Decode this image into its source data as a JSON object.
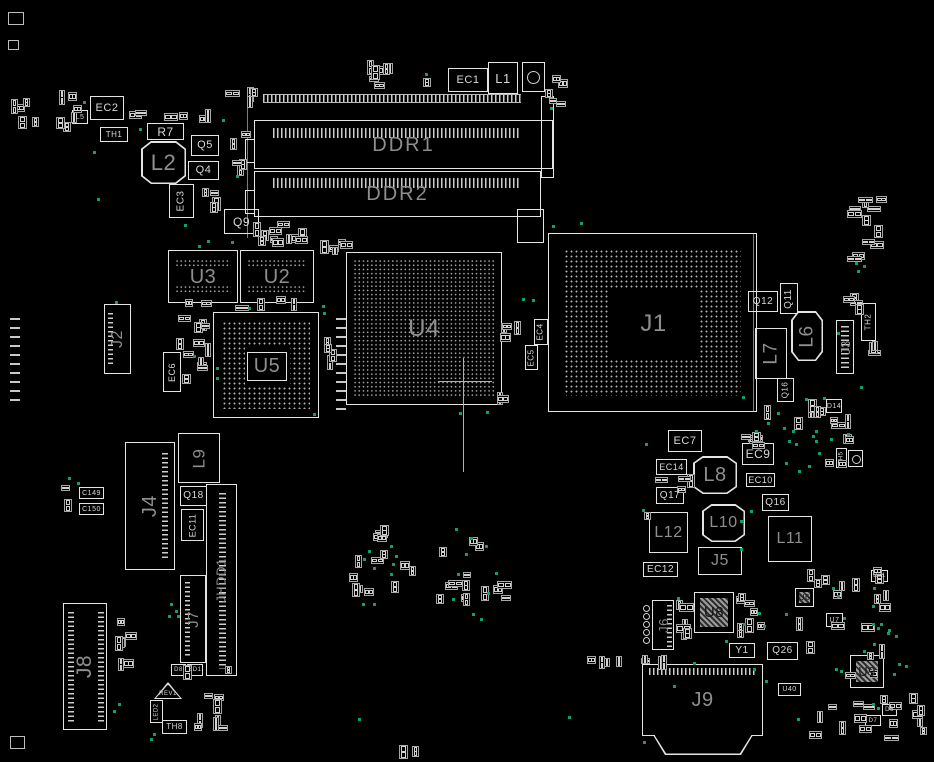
{
  "colors": {
    "background": "#000000",
    "outline": "#e4e4e4",
    "trace": "#7d7d7d",
    "label_bright": "#d8d8d8",
    "label_dim": "#8e8e8e",
    "label_dark": "#161616",
    "test_point": "#0aa076",
    "crosshair": "#e09aa2",
    "pad": "#d2d2d2",
    "small_part": "#a6a6a6"
  },
  "crosshair": {
    "x": 463,
    "y": 381,
    "v_from": 358,
    "v_to": 472,
    "h_from": 438,
    "h_to": 492
  },
  "lines": [
    [
      247,
      100,
      138
    ],
    [
      753,
      233,
      179
    ]
  ],
  "marks": [
    [
      8,
      12,
      16,
      13
    ],
    [
      8,
      40,
      11,
      10
    ],
    [
      10,
      736,
      15,
      13
    ]
  ],
  "padcols": [
    [
      10,
      318,
      10,
      88
    ],
    [
      336,
      318,
      10,
      96
    ]
  ],
  "dimm": {
    "strip_top": [
      263,
      94,
      258,
      9
    ],
    "slot1": {
      "box": [
        254,
        120,
        299,
        49
      ],
      "strip": [
        272,
        127,
        248,
        10
      ],
      "label": "DDR1"
    },
    "slot2": {
      "box": [
        254,
        171,
        287,
        46
      ],
      "strip": [
        272,
        177,
        248,
        10
      ],
      "label": "DDR2"
    },
    "right_bar": [
      541,
      96,
      13,
      82
    ],
    "notch": [
      517,
      209,
      27,
      34
    ],
    "ears": [
      [
        245,
        139,
        10,
        24
      ],
      [
        245,
        190,
        10,
        24
      ]
    ]
  },
  "components": [
    {
      "label": "EC1",
      "x": 448,
      "y": 68,
      "w": 40,
      "h": 24,
      "fs": 11
    },
    {
      "label": "L1",
      "x": 488,
      "y": 62,
      "w": 30,
      "h": 32,
      "fs": 13
    },
    {
      "label": "",
      "x": 522,
      "y": 62,
      "w": 23,
      "h": 30,
      "t": "circ"
    },
    {
      "label": "EC2",
      "x": 90,
      "y": 96,
      "w": 34,
      "h": 24,
      "fs": 11
    },
    {
      "label": "L5",
      "x": 72,
      "y": 110,
      "w": 16,
      "h": 14,
      "fs": 7
    },
    {
      "label": "TH1",
      "x": 100,
      "y": 127,
      "w": 28,
      "h": 15,
      "fs": 8
    },
    {
      "label": "R7",
      "x": 147,
      "y": 123,
      "w": 37,
      "h": 17,
      "fs": 12
    },
    {
      "label": "L2",
      "x": 141,
      "y": 141,
      "w": 45,
      "h": 43,
      "fs": 22,
      "t": "octo",
      "c": "dim"
    },
    {
      "label": "Q5",
      "x": 191,
      "y": 135,
      "w": 28,
      "h": 21,
      "fs": 11
    },
    {
      "label": "Q4",
      "x": 188,
      "y": 161,
      "w": 31,
      "h": 19,
      "fs": 11
    },
    {
      "label": "EC3",
      "x": 169,
      "y": 184,
      "w": 25,
      "h": 34,
      "fs": 10,
      "rot": 1
    },
    {
      "label": "Q9",
      "x": 224,
      "y": 209,
      "w": 35,
      "h": 25,
      "fs": 12
    },
    {
      "label": "U3",
      "x": 168,
      "y": 250,
      "w": 70,
      "h": 53,
      "fs": 20,
      "t": "band",
      "c": "dim"
    },
    {
      "label": "U2",
      "x": 240,
      "y": 250,
      "w": 74,
      "h": 53,
      "fs": 20,
      "t": "band",
      "c": "dim"
    },
    {
      "label": "J2",
      "x": 104,
      "y": 304,
      "w": 27,
      "h": 70,
      "fs": 16,
      "rot": 1,
      "t": "conn",
      "c": "dim",
      "strips": [
        [
          3,
          8,
          5,
          52
        ]
      ]
    },
    {
      "label": "U5",
      "x": 213,
      "y": 312,
      "w": 106,
      "h": 106,
      "fs": 20,
      "t": "bgacenter",
      "c": "dim",
      "inset": 8,
      "cbox": 1
    },
    {
      "label": "EC6",
      "x": 163,
      "y": 352,
      "w": 18,
      "h": 40,
      "fs": 9,
      "rot": 1
    },
    {
      "label": "U4",
      "x": 346,
      "y": 252,
      "w": 156,
      "h": 153,
      "fs": 24,
      "t": "bgagrid",
      "c": "dim"
    },
    {
      "label": "EC4",
      "x": 534,
      "y": 319,
      "w": 14,
      "h": 26,
      "fs": 8,
      "rot": 1
    },
    {
      "label": "EC5",
      "x": 525,
      "y": 345,
      "w": 13,
      "h": 25,
      "fs": 8,
      "rot": 1
    },
    {
      "label": "J1",
      "x": 548,
      "y": 233,
      "w": 209,
      "h": 179,
      "fs": 24,
      "t": "bgacenter",
      "c": "dim",
      "inset": 15
    },
    {
      "label": "Q12",
      "x": 748,
      "y": 291,
      "w": 30,
      "h": 21,
      "fs": 10
    },
    {
      "label": "Q11",
      "x": 780,
      "y": 283,
      "w": 18,
      "h": 31,
      "fs": 10,
      "rot": 1
    },
    {
      "label": "L7",
      "x": 755,
      "y": 328,
      "w": 32,
      "h": 51,
      "fs": 19,
      "rot": 1,
      "c": "dim"
    },
    {
      "label": "L6",
      "x": 791,
      "y": 311,
      "w": 32,
      "h": 50,
      "fs": 19,
      "rot": 1,
      "t": "octo",
      "c": "dim"
    },
    {
      "label": "J3",
      "x": 836,
      "y": 320,
      "w": 18,
      "h": 54,
      "fs": 13,
      "rot": 1,
      "t": "conn",
      "c": "dim",
      "strips": [
        [
          4,
          5,
          8,
          44
        ]
      ]
    },
    {
      "label": "Q16",
      "x": 777,
      "y": 378,
      "w": 17,
      "h": 24,
      "fs": 8,
      "rot": 1
    },
    {
      "label": "TH2",
      "x": 861,
      "y": 303,
      "w": 15,
      "h": 38,
      "fs": 8,
      "rot": 1
    },
    {
      "label": "D14",
      "x": 826,
      "y": 399,
      "w": 16,
      "h": 14,
      "fs": 7
    },
    {
      "label": "TH5",
      "x": 836,
      "y": 448,
      "w": 11,
      "h": 20,
      "fs": 6,
      "rot": 1
    },
    {
      "label": "",
      "x": 848,
      "y": 450,
      "w": 15,
      "h": 17,
      "t": "circ"
    },
    {
      "label": "EC7",
      "x": 668,
      "y": 430,
      "w": 34,
      "h": 22,
      "fs": 11
    },
    {
      "label": "EC14",
      "x": 656,
      "y": 459,
      "w": 31,
      "h": 16,
      "fs": 9
    },
    {
      "label": "EC9",
      "x": 742,
      "y": 443,
      "w": 32,
      "h": 22,
      "fs": 12
    },
    {
      "label": "L8",
      "x": 693,
      "y": 456,
      "w": 44,
      "h": 38,
      "fs": 20,
      "t": "octo",
      "c": "dim"
    },
    {
      "label": "EC10",
      "x": 746,
      "y": 473,
      "w": 29,
      "h": 14,
      "fs": 9
    },
    {
      "label": "Q17",
      "x": 656,
      "y": 487,
      "w": 28,
      "h": 17,
      "fs": 10
    },
    {
      "label": "Q16",
      "x": 762,
      "y": 494,
      "w": 27,
      "h": 17,
      "fs": 10
    },
    {
      "label": "L12",
      "x": 649,
      "y": 512,
      "w": 39,
      "h": 41,
      "fs": 16,
      "c": "dim"
    },
    {
      "label": "L10",
      "x": 702,
      "y": 504,
      "w": 43,
      "h": 38,
      "fs": 16,
      "t": "octo",
      "c": "dim"
    },
    {
      "label": "L11",
      "x": 768,
      "y": 516,
      "w": 44,
      "h": 46,
      "fs": 16,
      "c": "dim"
    },
    {
      "label": "J5",
      "x": 698,
      "y": 547,
      "w": 44,
      "h": 28,
      "fs": 16,
      "c": "dim"
    },
    {
      "label": "EC12",
      "x": 643,
      "y": 562,
      "w": 35,
      "h": 15,
      "fs": 10
    },
    {
      "label": "C149",
      "x": 79,
      "y": 487,
      "w": 25,
      "h": 12,
      "fs": 7
    },
    {
      "label": "C150",
      "x": 79,
      "y": 503,
      "w": 25,
      "h": 12,
      "fs": 7
    },
    {
      "label": "J4",
      "x": 125,
      "y": 442,
      "w": 50,
      "h": 128,
      "fs": 20,
      "rot": 1,
      "t": "conn",
      "c": "dim",
      "strips": [
        [
          36,
          10,
          6,
          108
        ]
      ]
    },
    {
      "label": "L9",
      "x": 178,
      "y": 433,
      "w": 42,
      "h": 50,
      "fs": 17,
      "rot": 1,
      "c": "dim"
    },
    {
      "label": "Q18",
      "x": 180,
      "y": 486,
      "w": 27,
      "h": 20,
      "fs": 10
    },
    {
      "label": "EC11",
      "x": 181,
      "y": 509,
      "w": 23,
      "h": 32,
      "fs": 9,
      "rot": 1
    },
    {
      "label": "JHDD1",
      "x": 206,
      "y": 484,
      "w": 31,
      "h": 192,
      "fs": 13,
      "rot": 1,
      "t": "conn",
      "c": "dim",
      "strips": [
        [
          12,
          8,
          7,
          176
        ]
      ]
    },
    {
      "label": "J7",
      "x": 180,
      "y": 575,
      "w": 26,
      "h": 88,
      "fs": 15,
      "rot": 1,
      "t": "conn",
      "c": "dim",
      "strips": [
        [
          4,
          6,
          5,
          76
        ]
      ]
    },
    {
      "label": "J8",
      "x": 63,
      "y": 603,
      "w": 44,
      "h": 127,
      "fs": 21,
      "rot": 1,
      "t": "conn",
      "c": "dim",
      "strips": [
        [
          4,
          8,
          6,
          110
        ],
        [
          34,
          8,
          6,
          110
        ]
      ]
    },
    {
      "label": "D8",
      "x": 171,
      "y": 664,
      "w": 15,
      "h": 12,
      "fs": 6
    },
    {
      "label": "ZD1",
      "x": 187,
      "y": 664,
      "w": 16,
      "h": 12,
      "fs": 6
    },
    {
      "label": "REV1",
      "x": 154,
      "y": 682,
      "w": 28,
      "h": 17,
      "fs": 6,
      "t": "tri"
    },
    {
      "label": "LED2",
      "x": 150,
      "y": 700,
      "w": 13,
      "h": 23,
      "fs": 6,
      "rot": 1
    },
    {
      "label": "TH8",
      "x": 162,
      "y": 720,
      "w": 25,
      "h": 14,
      "fs": 8
    },
    {
      "label": "J6",
      "x": 652,
      "y": 600,
      "w": 22,
      "h": 50,
      "fs": 13,
      "rot": 1,
      "t": "conn",
      "c": "dim",
      "strips": [
        [
          14,
          4,
          5,
          42
        ]
      ],
      "circles": {
        "x": 643,
        "y": 605,
        "n": 5,
        "d": 7,
        "step": 8
      }
    },
    {
      "label": "U8",
      "x": 694,
      "y": 592,
      "w": 40,
      "h": 41,
      "fs": 15,
      "t": "qfn"
    },
    {
      "label": "Y1",
      "x": 729,
      "y": 643,
      "w": 26,
      "h": 15,
      "fs": 10
    },
    {
      "label": "Q26",
      "x": 767,
      "y": 642,
      "w": 31,
      "h": 18,
      "fs": 10
    },
    {
      "label": "U40",
      "x": 778,
      "y": 683,
      "w": 23,
      "h": 13,
      "fs": 7
    },
    {
      "label": "J9",
      "x": 642,
      "y": 664,
      "w": 121,
      "h": 72,
      "fs": 20,
      "t": "j9",
      "c": "dim"
    },
    {
      "label": "U6",
      "x": 795,
      "y": 588,
      "w": 19,
      "h": 19,
      "fs": 8,
      "t": "qfn"
    },
    {
      "label": "U7",
      "x": 826,
      "y": 613,
      "w": 17,
      "h": 14,
      "fs": 7
    },
    {
      "label": "D21",
      "x": 871,
      "y": 570,
      "w": 17,
      "h": 12,
      "fs": 6
    },
    {
      "label": "U9",
      "x": 850,
      "y": 655,
      "w": 34,
      "h": 33,
      "fs": 13,
      "t": "qfn"
    },
    {
      "label": "D6",
      "x": 882,
      "y": 704,
      "w": 15,
      "h": 12,
      "fs": 6
    },
    {
      "label": "D7",
      "x": 865,
      "y": 715,
      "w": 16,
      "h": 11,
      "fs": 6
    }
  ],
  "clusters": [
    [
      55,
      85,
      35,
      48,
      6
    ],
    [
      8,
      92,
      34,
      38,
      5
    ],
    [
      128,
      108,
      100,
      16,
      6
    ],
    [
      225,
      85,
      35,
      28,
      4
    ],
    [
      228,
      130,
      24,
      78,
      5
    ],
    [
      200,
      185,
      24,
      52,
      4
    ],
    [
      250,
      218,
      64,
      30,
      7
    ],
    [
      255,
      236,
      110,
      14,
      6
    ],
    [
      180,
      296,
      130,
      16,
      6
    ],
    [
      318,
      238,
      28,
      22,
      3
    ],
    [
      360,
      60,
      72,
      34,
      8
    ],
    [
      543,
      68,
      30,
      46,
      5
    ],
    [
      496,
      320,
      36,
      24,
      4
    ],
    [
      497,
      392,
      20,
      13,
      2
    ],
    [
      175,
      315,
      37,
      72,
      12
    ],
    [
      320,
      330,
      22,
      84,
      4
    ],
    [
      640,
      470,
      58,
      54,
      5
    ],
    [
      738,
      420,
      26,
      25,
      3
    ],
    [
      748,
      398,
      110,
      72,
      15
    ],
    [
      845,
      195,
      45,
      68,
      12
    ],
    [
      840,
      293,
      26,
      24,
      4
    ],
    [
      795,
      565,
      105,
      68,
      14
    ],
    [
      730,
      585,
      38,
      54,
      8
    ],
    [
      635,
      655,
      45,
      16,
      4
    ],
    [
      676,
      600,
      20,
      52,
      6
    ],
    [
      800,
      640,
      130,
      116,
      18
    ],
    [
      345,
      525,
      75,
      84,
      14
    ],
    [
      425,
      530,
      90,
      84,
      14
    ],
    [
      108,
      618,
      30,
      58,
      8
    ],
    [
      182,
      652,
      58,
      90,
      10
    ],
    [
      398,
      745,
      28,
      13,
      3
    ],
    [
      60,
      484,
      14,
      32,
      2
    ],
    [
      868,
      338,
      12,
      22,
      3
    ],
    [
      905,
      698,
      25,
      42,
      4
    ],
    [
      582,
      656,
      52,
      12,
      4
    ]
  ],
  "dots": [
    [
      83,
      101
    ],
    [
      139,
      128
    ],
    [
      222,
      119
    ],
    [
      236,
      175
    ],
    [
      93,
      151
    ],
    [
      97,
      198
    ],
    [
      184,
      224
    ],
    [
      231,
      241
    ],
    [
      425,
      73
    ],
    [
      550,
      107
    ],
    [
      552,
      225
    ],
    [
      580,
      222
    ],
    [
      115,
      301
    ],
    [
      198,
      245
    ],
    [
      207,
      240
    ],
    [
      248,
      307
    ],
    [
      322,
      305
    ],
    [
      216,
      367
    ],
    [
      216,
      377
    ],
    [
      193,
      355
    ],
    [
      313,
      413
    ],
    [
      323,
      312
    ],
    [
      522,
      298
    ],
    [
      532,
      299
    ],
    [
      459,
      412
    ],
    [
      486,
      411
    ],
    [
      837,
      332
    ],
    [
      860,
      386
    ],
    [
      823,
      397
    ],
    [
      805,
      398
    ],
    [
      742,
      396
    ],
    [
      783,
      427
    ],
    [
      812,
      435
    ],
    [
      795,
      443
    ],
    [
      818,
      452
    ],
    [
      808,
      465
    ],
    [
      785,
      462
    ],
    [
      645,
      443
    ],
    [
      642,
      509
    ],
    [
      740,
      548
    ],
    [
      740,
      520
    ],
    [
      750,
      510
    ],
    [
      677,
      597
    ],
    [
      758,
      612
    ],
    [
      785,
      613
    ],
    [
      743,
      623
    ],
    [
      763,
      625
    ],
    [
      693,
      662
    ],
    [
      725,
      640
    ],
    [
      753,
      668
    ],
    [
      765,
      680
    ],
    [
      673,
      685
    ],
    [
      832,
      587
    ],
    [
      837,
      595
    ],
    [
      873,
      587
    ],
    [
      872,
      605
    ],
    [
      843,
      617
    ],
    [
      872,
      623
    ],
    [
      887,
      632
    ],
    [
      873,
      643
    ],
    [
      835,
      668
    ],
    [
      840,
      670
    ],
    [
      893,
      673
    ],
    [
      797,
      718
    ],
    [
      390,
      545
    ],
    [
      395,
      555
    ],
    [
      363,
      558
    ],
    [
      368,
      550
    ],
    [
      392,
      563
    ],
    [
      373,
      567
    ],
    [
      390,
      573
    ],
    [
      362,
      603
    ],
    [
      373,
      603
    ],
    [
      455,
      528
    ],
    [
      470,
      537
    ],
    [
      485,
      545
    ],
    [
      465,
      553
    ],
    [
      457,
      573
    ],
    [
      495,
      572
    ],
    [
      487,
      592
    ],
    [
      452,
      598
    ],
    [
      472,
      613
    ],
    [
      480,
      618
    ],
    [
      170,
      603
    ],
    [
      177,
      615
    ],
    [
      168,
      615
    ],
    [
      175,
      610
    ],
    [
      118,
      703
    ],
    [
      113,
      710
    ],
    [
      150,
      738
    ],
    [
      153,
      733
    ],
    [
      855,
      262
    ],
    [
      863,
      265
    ],
    [
      857,
      270
    ],
    [
      777,
      412
    ],
    [
      792,
      430
    ],
    [
      815,
      430
    ],
    [
      830,
      438
    ],
    [
      847,
      433
    ],
    [
      767,
      422
    ],
    [
      755,
      430
    ],
    [
      788,
      440
    ],
    [
      815,
      440
    ],
    [
      798,
      470
    ],
    [
      877,
      627
    ],
    [
      880,
      623
    ],
    [
      895,
      635
    ],
    [
      888,
      629
    ],
    [
      863,
      650
    ],
    [
      898,
      663
    ],
    [
      905,
      665
    ],
    [
      872,
      703
    ],
    [
      877,
      707
    ],
    [
      358,
      718
    ],
    [
      568,
      716
    ],
    [
      643,
      741
    ],
    [
      68,
      477
    ],
    [
      77,
      482
    ]
  ]
}
